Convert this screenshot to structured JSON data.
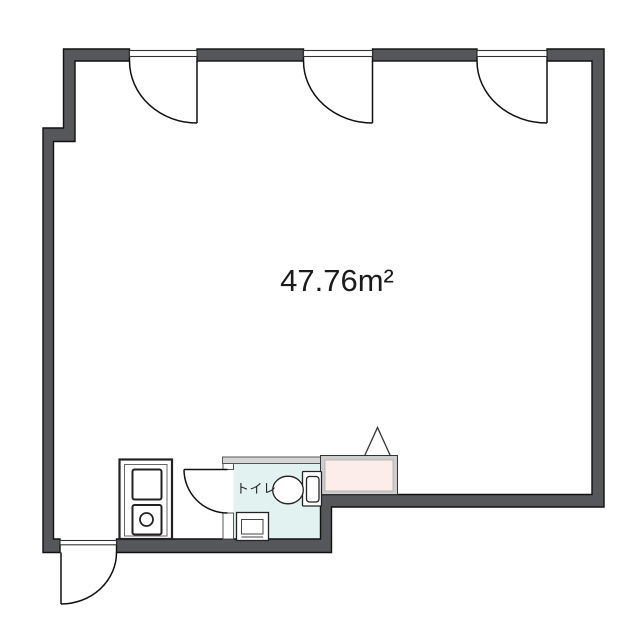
{
  "labels": {
    "area": "47.76m²",
    "toilet": "トイレ"
  },
  "colors": {
    "background": "#ffffff",
    "wall": "#56575a",
    "wall_outline": "#111111",
    "toilet_room_floor": "#e2f2f1",
    "partition_fill": "#d6d6d6",
    "counter_frame": "#cdcdcd",
    "counter_fill": "#fcecea",
    "fixture_stroke": "#222222",
    "text": "#1b1b1b"
  },
  "features": {
    "top_swing_doors": 3,
    "entrance_door": 1,
    "toilet_door": 1,
    "toilet_room": 1,
    "counter_unit": 1,
    "vanity_unit": 1
  }
}
